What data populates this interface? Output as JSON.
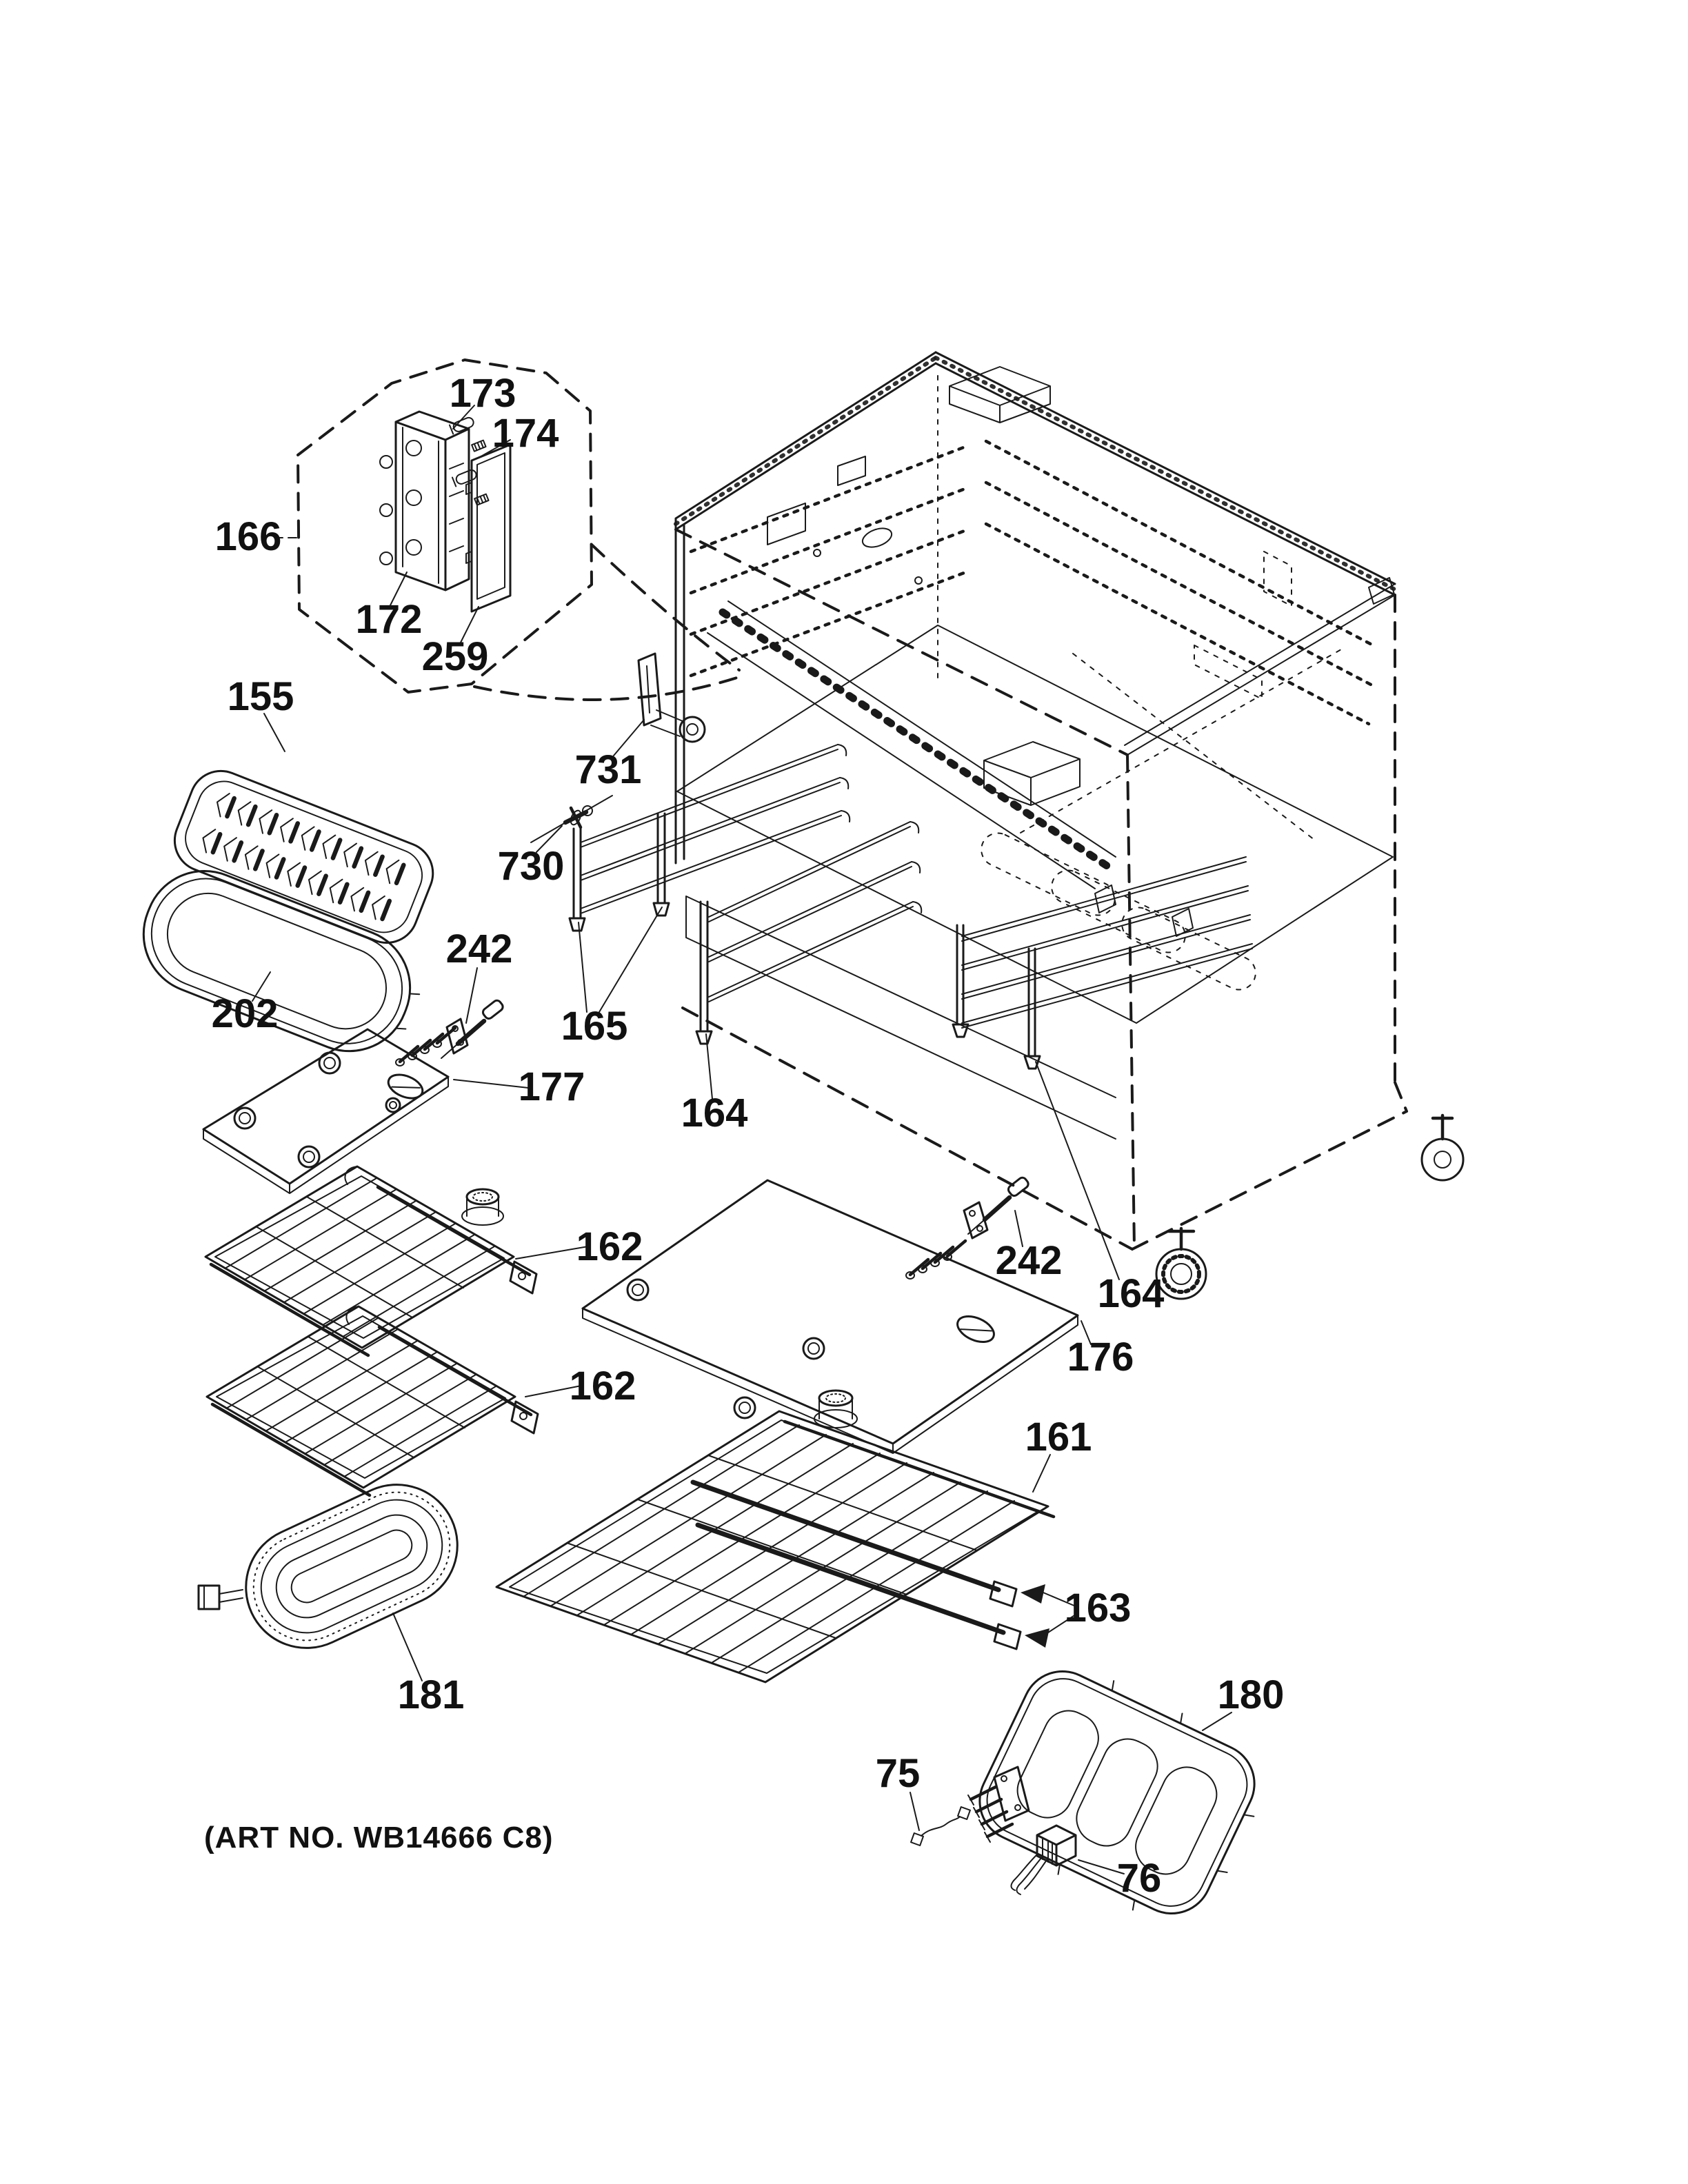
{
  "page": {
    "background": "#ffffff",
    "ink": "#1a1a1a",
    "art_no": "(ART NO. WB14666 C8)"
  },
  "callouts": [
    {
      "part": "173"
    },
    {
      "part": "174"
    },
    {
      "part": "166"
    },
    {
      "part": "172"
    },
    {
      "part": "259"
    },
    {
      "part": "155"
    },
    {
      "part": "731"
    },
    {
      "part": "730"
    },
    {
      "part": "202"
    },
    {
      "part": "242"
    },
    {
      "part": "177"
    },
    {
      "part": "165"
    },
    {
      "part": "164"
    },
    {
      "part": "162"
    },
    {
      "part": "162"
    },
    {
      "part": "176"
    },
    {
      "part": "242"
    },
    {
      "part": "164"
    },
    {
      "part": "161"
    },
    {
      "part": "163"
    },
    {
      "part": "181"
    },
    {
      "part": "180"
    },
    {
      "part": "75"
    },
    {
      "part": "76"
    }
  ]
}
